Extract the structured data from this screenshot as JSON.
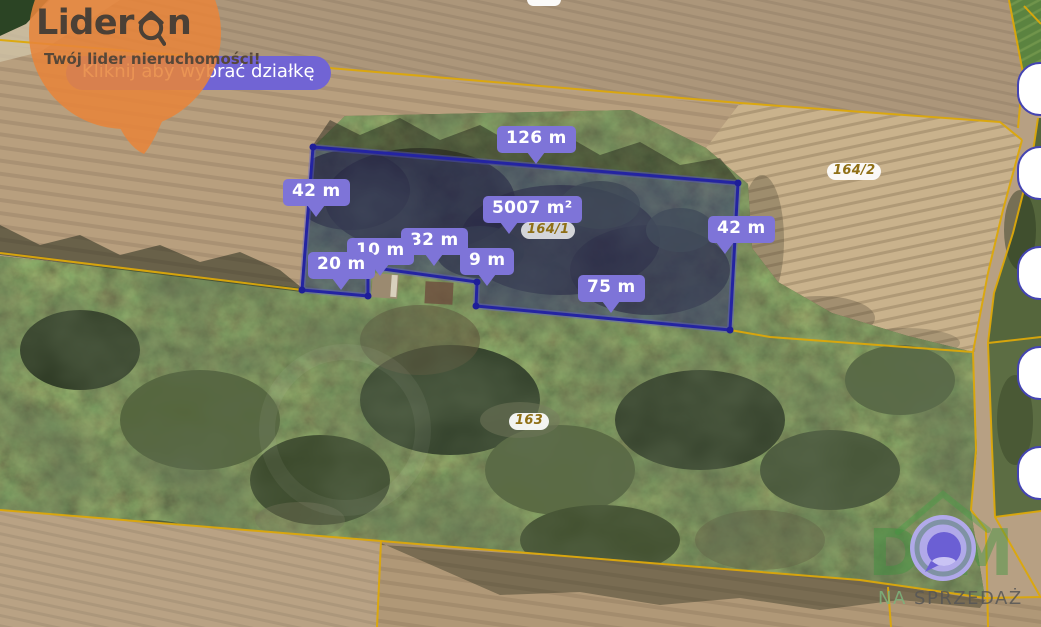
{
  "branding": {
    "logo_prefix": "Lider",
    "logo_suffix": "n",
    "tagline": "Twój lider nieruchomości!",
    "tooltip": "Kliknij aby wybrać działkę"
  },
  "labels": [
    {
      "text": "126 m"
    },
    {
      "text": "42 m"
    },
    {
      "text": "5007 m²"
    },
    {
      "text": "42 m"
    },
    {
      "text": "32 m"
    },
    {
      "text": "10 m"
    },
    {
      "text": "20 m"
    },
    {
      "text": "9 m"
    },
    {
      "text": "75 m"
    }
  ],
  "parcels": {
    "main": "164/1",
    "right": "164/2",
    "south": "163"
  },
  "watermark": {
    "letter_d": "D",
    "letter_m": "M",
    "prefix": "NA",
    "word": "SPRZEDAŻ"
  },
  "colors": {
    "label_purple": "#7E74D8",
    "tooltip_purple": "#7164D4",
    "parcel_navy": "#2424A2",
    "cadastral_yellow": "#DCA80A",
    "brand_orange": "#E8853B"
  }
}
